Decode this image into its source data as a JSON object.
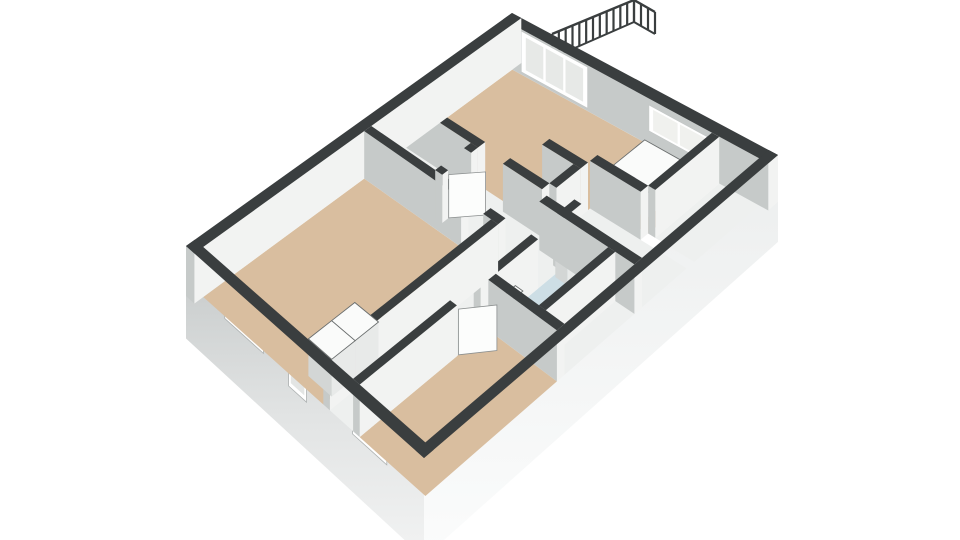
{
  "scene": {
    "width": 960,
    "height": 540,
    "background": "#ffffff",
    "colors": {
      "wall_top": "#3a3e3f",
      "wall_face_light": "#f2f3f2",
      "wall_face_shade": "#c6cac9",
      "exterior_sw_top": "#c3c7c7",
      "exterior_sw_bottom": "#f2f3f3",
      "exterior_se": "#f9fafa",
      "floor_tan": "#d9be9f",
      "floor_white": "#eef0ef",
      "floor_blue": "#cddee5",
      "window_frame": "#ffffff",
      "fixture_white": "#fafbfa",
      "railing": "#3a3e3f"
    }
  },
  "plan": {
    "size": [
      10.2,
      8.0
    ],
    "base_h": -0.85,
    "quad_top": [
      [
        186,
        246
      ],
      [
        512,
        13
      ],
      [
        778,
        155
      ],
      [
        424,
        458
      ]
    ],
    "quad_floor": [
      [
        186,
        296
      ],
      [
        512,
        58
      ],
      [
        778,
        202
      ],
      [
        424,
        512
      ]
    ],
    "floors": [
      {
        "name": "floor-bedroom-1",
        "color": "#d9be9f",
        "rect": [
          0.28,
          0.28,
          5.3,
          4.3
        ]
      },
      {
        "name": "floor-entry-closet",
        "color": "#eef0ef",
        "rect": [
          5.52,
          0.28,
          6.61,
          2.3
        ]
      },
      {
        "name": "floor-hall",
        "color": "#eef0ef",
        "rect": [
          5.3,
          2.3,
          6.83,
          4.52
        ]
      },
      {
        "name": "floor-passage",
        "color": "#eef0ef",
        "rect": [
          6.61,
          2.52,
          6.83,
          3.3
        ]
      },
      {
        "name": "floor-living-room",
        "color": "#d9be9f",
        "poly": [
          [
            6.83,
            0.28
          ],
          [
            9.92,
            0.28
          ],
          [
            9.92,
            6.3
          ],
          [
            8.05,
            6.3
          ],
          [
            8.05,
            4.74
          ],
          [
            7.77,
            4.74
          ],
          [
            7.77,
            3.55
          ],
          [
            7.55,
            3.55
          ],
          [
            7.55,
            4.52
          ],
          [
            6.83,
            4.52
          ]
        ]
      },
      {
        "name": "floor-corridor",
        "color": "#eef0ef",
        "rect": [
          0.28,
          4.3,
          6.83,
          5.52
        ]
      },
      {
        "name": "floor-bathroom",
        "color": "#cddee5",
        "rect": [
          4.3,
          5.52,
          6.32,
          6.9
        ]
      },
      {
        "name": "floor-bedroom-2",
        "color": "#d9be9f",
        "rect": [
          0.28,
          5.52,
          4.08,
          7.72
        ]
      },
      {
        "name": "floor-back-room",
        "color": "#eef0ef",
        "rect": [
          6.54,
          4.74,
          7.83,
          7.72
        ]
      },
      {
        "name": "floor-back-strip",
        "color": "#eef0ef",
        "rect": [
          4.3,
          7.12,
          6.32,
          7.72
        ]
      },
      {
        "name": "floor-alcove-south",
        "color": "#eef0ef",
        "rect": [
          8.05,
          6.52,
          9.92,
          7.72
        ]
      }
    ],
    "walls": [
      {
        "name": "facade-nw",
        "rect": [
          0,
          0,
          10.2,
          0.28
        ]
      },
      {
        "name": "facade-ne",
        "rect": [
          9.92,
          0,
          10.2,
          8
        ],
        "decals": [
          {
            "type": "glass-wall",
            "b1": 0.55,
            "b2": 2.55,
            "h1": 0.06,
            "h2": 0.96,
            "panes": 3,
            "glass": "#e7e9e7"
          },
          {
            "type": "window",
            "b1": 4.4,
            "b2": 6.2,
            "h1": 0.3,
            "h2": 0.86,
            "panes": 2,
            "glass": "#f0f1ee"
          }
        ]
      },
      {
        "name": "facade-sw-cap",
        "rect": [
          0,
          0,
          0.28,
          8
        ],
        "topOnly": true
      },
      {
        "name": "facade-se-cap",
        "rect": [
          0,
          7.72,
          10.2,
          8
        ],
        "topOnly": true
      },
      {
        "name": "wall-bed1-right-upper",
        "rect": [
          5.3,
          0.28,
          5.52,
          3.35
        ]
      },
      {
        "name": "wall-bed1-right-lower",
        "rect": [
          5.3,
          4.05,
          5.52,
          4.52
        ]
      },
      {
        "name": "wall-closet-right",
        "rect": [
          6.61,
          0.28,
          6.83,
          2.52
        ]
      },
      {
        "name": "wall-living-left",
        "rect": [
          6.61,
          3.3,
          6.83,
          4.52
        ]
      },
      {
        "name": "wall-closet-jamb-left",
        "rect": [
          5.52,
          2.3,
          5.7,
          2.52
        ]
      },
      {
        "name": "wall-closet-jamb-right",
        "rect": [
          6.4,
          2.3,
          6.61,
          2.52
        ]
      },
      {
        "name": "wall-bed1-south",
        "rect": [
          0.28,
          4.3,
          5.3,
          4.52
        ]
      },
      {
        "name": "wall-corridor-south-1",
        "rect": [
          0.28,
          5.3,
          3.15,
          5.52
        ]
      },
      {
        "name": "wall-corridor-south-2",
        "rect": [
          3.85,
          5.3,
          5.55,
          5.52
        ]
      },
      {
        "name": "wall-corridor-south-3",
        "rect": [
          6.2,
          5.3,
          6.83,
          5.52
        ]
      },
      {
        "name": "wall-bed2-right",
        "rect": [
          4.08,
          5.52,
          4.3,
          7.72
        ]
      },
      {
        "name": "wall-bath-right",
        "rect": [
          6.32,
          4.74,
          6.54,
          7.72
        ]
      },
      {
        "name": "wall-bath-south",
        "rect": [
          4.3,
          6.9,
          6.32,
          7.12
        ]
      },
      {
        "name": "wall-living-south",
        "rect": [
          6.83,
          4.52,
          7.55,
          4.74
        ]
      },
      {
        "name": "wall-living-stub",
        "rect": [
          7.55,
          3.55,
          7.77,
          4.74
        ]
      },
      {
        "name": "wall-alcove-left",
        "rect": [
          7.83,
          4.74,
          8.05,
          6.3
        ]
      },
      {
        "name": "wall-alcove-south",
        "rect": [
          8.05,
          6.3,
          9.92,
          6.52
        ]
      }
    ],
    "shell_windows": [
      {
        "name": "window-bedroom-1",
        "b1": 1.3,
        "b2": 2.6,
        "h1": 0.25,
        "h2": 0.8,
        "panes": 2,
        "glass": "#d8c9b6"
      },
      {
        "name": "door-facade-sw",
        "b1": 3.45,
        "b2": 4.05,
        "h1": 0.06,
        "h2": 0.84,
        "panes": 1,
        "glass": "#e3e5e4"
      },
      {
        "name": "window-bedroom-2",
        "b1": 5.6,
        "b2": 6.75,
        "h1": 0.25,
        "h2": 0.8,
        "panes": 2,
        "glass": "#dccdba"
      }
    ],
    "boxes": [
      {
        "name": "wardrobe-cell-1",
        "rect": [
          0.55,
          3.5,
          1.25,
          4.28
        ],
        "h": 0.72
      },
      {
        "name": "wardrobe-cell-2",
        "rect": [
          1.25,
          3.5,
          1.95,
          4.28
        ],
        "h": 0.72
      },
      {
        "name": "kitchen-block",
        "rect": [
          8.35,
          4.75,
          9.45,
          5.95
        ],
        "h": 0.52
      },
      {
        "name": "bath-sink",
        "rect": [
          6.0,
          5.58,
          6.3,
          5.96
        ],
        "h": 0.5
      },
      {
        "name": "toilet-tank",
        "rect": [
          4.42,
          5.56,
          4.84,
          5.8
        ],
        "h": 0.48
      }
    ],
    "toilet_bowl": {
      "cx": 4.63,
      "cy": 6.06,
      "r": 0.22,
      "h": 0.3
    },
    "door_leaves": [
      {
        "name": "door-leaf-entry-closet",
        "from": [
          5.72,
          2.52
        ],
        "to": [
          6.3,
          3.08
        ],
        "h": 0.9
      },
      {
        "name": "door-leaf-bedroom-2",
        "from": [
          3.2,
          5.52
        ],
        "to": [
          3.82,
          6.08
        ],
        "h": 0.9
      }
    ],
    "railing": {
      "bottom_from": [
        552,
        58
      ],
      "bottom_to": [
        634,
        22
      ],
      "top_from": [
        552,
        34
      ],
      "top_to": [
        634,
        0
      ],
      "bars": 13,
      "return": {
        "bottom_from": [
          634,
          22
        ],
        "bottom_to": [
          655,
          34
        ],
        "top_from": [
          634,
          0
        ],
        "top_to": [
          655,
          12
        ],
        "bars": 4
      }
    }
  }
}
